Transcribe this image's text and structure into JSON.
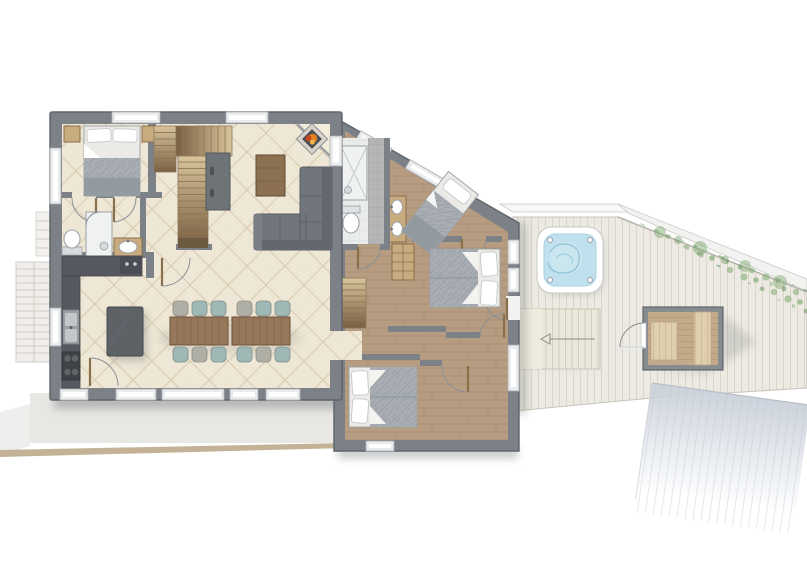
{
  "scene": "floor-plan",
  "inventory": {
    "bedrooms": 4,
    "bathrooms": 2,
    "beds": 4,
    "dining_tables": 2,
    "dining_chairs": 12,
    "kitchen_burners": 4,
    "bathroom_sinks": 3,
    "toilets": 2,
    "showers": 2,
    "staircases": 4,
    "hot_tub": 1,
    "sauna": 1,
    "fireplace": 1,
    "sofa_sections": 2,
    "hot_tub_jets": 4
  },
  "colors": {
    "wall": "#7b8187",
    "wall-dark": "#5e646a",
    "tile-floor": "#efe7d5",
    "tile-line": "#d8cbb0",
    "wood-floor": "#b69c81",
    "wood-line": "#a5896d",
    "deck": "#eceae2",
    "deck-line": "#d8d5c9",
    "terrace": "#e7e7e4",
    "tan-edge": "#c3b296",
    "water": "#bfe0ec",
    "water-line": "#8fc3d8",
    "green": "#7fa873",
    "counter": "#565a60",
    "island": "#5d6267",
    "sofa": "#71767c",
    "table-wood": "#96775a",
    "chair-teal": "#9fb8b6",
    "chair-gray": "#b0afa6",
    "bed-blanket": "#a7adb2",
    "bed-white": "#eceae6",
    "cabinet-wood": "#c9ab80",
    "sauna-wood": "#c3aa8a",
    "bench-wood": "#e0cfae",
    "stair-light": "#d9c49c",
    "stair-dark": "#7a5f42",
    "fire-orange": "#e2801f",
    "gray-tile": "#b3b5b6",
    "white-tile": "#eaebeb",
    "window": "#e9ebec",
    "pad": "#cdd3dc"
  }
}
